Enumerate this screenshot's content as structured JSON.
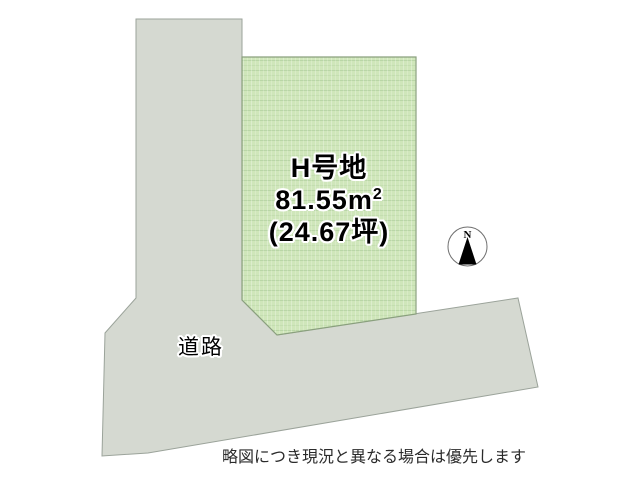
{
  "plot": {
    "name": "H号地",
    "area_sqm": "81.55m",
    "area_sqm_sup": "2",
    "area_tsubo": "(24.67坪)"
  },
  "road": {
    "label": "道路"
  },
  "compass": {
    "north_label": "N"
  },
  "disclaimer": "略図につき現況と異なる場合は優先します",
  "colors": {
    "background": "#ffffff",
    "road_fill": "#d5d9d1",
    "road_border": "#9ba39a",
    "plot_fill": "#cfe6ba",
    "plot_texture_row": "#b9d6a6",
    "plot_texture_row2": "#c4deb0",
    "plot_border": "#8aa07e",
    "compass_outline": "#6f6f6f",
    "arrow_fill": "#000000",
    "label_text": "#000000",
    "disclaimer_text": "#2b2b2b"
  }
}
